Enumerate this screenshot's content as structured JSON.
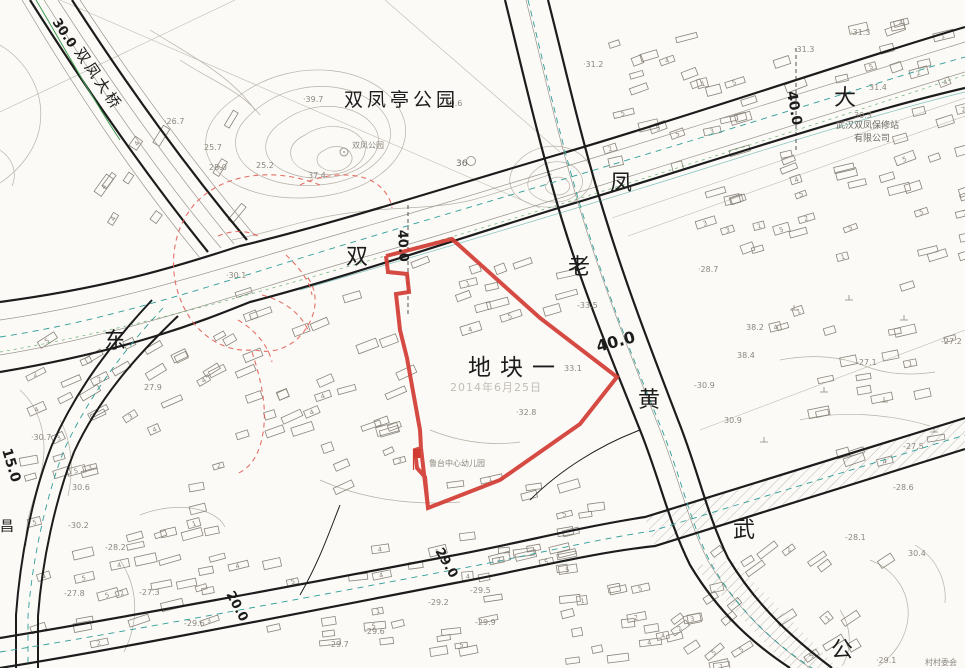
{
  "map": {
    "plot_label": "地块一",
    "date_watermark": "2014年6月25日",
    "labels": [
      {
        "name": "road-name-dong",
        "text": "东",
        "x": 104,
        "y": 348,
        "size": 22
      },
      {
        "name": "road-name-shuang",
        "text": "双",
        "x": 346,
        "y": 264,
        "size": 22
      },
      {
        "name": "road-name-feng",
        "text": "凤",
        "x": 610,
        "y": 190,
        "size": 22
      },
      {
        "name": "road-name-da",
        "text": "大",
        "x": 834,
        "y": 105,
        "size": 22
      },
      {
        "name": "road-name-lao",
        "text": "老",
        "x": 568,
        "y": 274,
        "size": 22
      },
      {
        "name": "road-name-huang",
        "text": "黄",
        "x": 638,
        "y": 407,
        "size": 22
      },
      {
        "name": "road-name-wu",
        "text": "武",
        "x": 733,
        "y": 537,
        "size": 22
      },
      {
        "name": "road-name-gong",
        "text": "公",
        "x": 831,
        "y": 657,
        "size": 22
      },
      {
        "name": "road-name-chang",
        "text": "昌",
        "x": 0,
        "y": 531,
        "size": 14
      },
      {
        "name": "bridge-name",
        "text": "双凤大桥",
        "x": 74,
        "y": 52,
        "size": 15,
        "rot": 56,
        "ls": 3
      },
      {
        "name": "park-name",
        "text": "双凤亭公园",
        "x": 344,
        "y": 106,
        "size": 19,
        "ls": 4
      },
      {
        "name": "park-subname",
        "text": "双凤公园",
        "x": 352,
        "y": 148,
        "size": 8,
        "color": "#8d887f"
      },
      {
        "name": "plot-name",
        "text": "地块一",
        "x": 468,
        "y": 375,
        "size": 23,
        "ls": 9
      },
      {
        "name": "date-watermark",
        "text": "2014年6月25日",
        "x": 450,
        "y": 391,
        "size": 11,
        "ls": 1,
        "color": "#c2beb6"
      },
      {
        "name": "road-width-30",
        "text": "30.0",
        "x": 52,
        "y": 22,
        "size": 13,
        "rot": 56,
        "bold": true
      },
      {
        "name": "road-width-40-a",
        "text": "40.0",
        "x": 398,
        "y": 230,
        "size": 13,
        "rot": 87,
        "bold": true
      },
      {
        "name": "road-width-40-b",
        "text": "40.0",
        "x": 787,
        "y": 92,
        "size": 14,
        "rot": 80,
        "bold": true
      },
      {
        "name": "road-width-40-c",
        "text": "40.0",
        "x": 598,
        "y": 352,
        "size": 16,
        "rot": -15,
        "bold": true
      },
      {
        "name": "road-width-15",
        "text": "15.0",
        "x": 2,
        "y": 450,
        "size": 14,
        "rot": 73,
        "bold": true
      },
      {
        "name": "road-width-20",
        "text": "20.0",
        "x": 226,
        "y": 594,
        "size": 13,
        "rot": 62,
        "bold": true
      },
      {
        "name": "road-width-29",
        "text": "29.0",
        "x": 435,
        "y": 551,
        "size": 13,
        "rot": 60,
        "bold": true
      },
      {
        "name": "kindergarten-label",
        "text": "鲁台中心幼儿园",
        "x": 429,
        "y": 466,
        "size": 8,
        "color": "#8d887f"
      },
      {
        "name": "company-label-line1",
        "text": "武汉双凤保修站",
        "x": 836,
        "y": 128,
        "size": 9,
        "color": "#6e6a63"
      },
      {
        "name": "company-label-line2",
        "text": "有限公司",
        "x": 854,
        "y": 141,
        "size": 9,
        "color": "#6e6a63"
      },
      {
        "name": "committee-label",
        "text": "村村委会",
        "x": 925,
        "y": 665,
        "size": 8,
        "color": "#8d887f"
      },
      {
        "name": "hill-36-label",
        "text": "36",
        "x": 456,
        "y": 166,
        "size": 9,
        "color": "#6e6a63"
      }
    ],
    "spot_elevations": [
      {
        "v": "·39.7",
        "x": 303,
        "y": 102
      },
      {
        "v": "·39.6",
        "x": 442,
        "y": 106
      },
      {
        "v": "37.4",
        "x": 308,
        "y": 178
      },
      {
        "v": "25.7",
        "x": 204,
        "y": 150
      },
      {
        "v": "28.0",
        "x": 209,
        "y": 170
      },
      {
        "v": "25.2",
        "x": 256,
        "y": 168
      },
      {
        "v": "·30.1",
        "x": 226,
        "y": 278
      },
      {
        "v": "·26.7",
        "x": 164,
        "y": 124
      },
      {
        "v": "·31.2",
        "x": 583,
        "y": 67
      },
      {
        "v": "·31.3",
        "x": 850,
        "y": 35
      },
      {
        "v": "·31.3",
        "x": 794,
        "y": 52
      },
      {
        "v": "31.4",
        "x": 869,
        "y": 90
      },
      {
        "v": "30.3",
        "x": 854,
        "y": 118
      },
      {
        "v": "·28.7",
        "x": 698,
        "y": 272
      },
      {
        "v": "-33.5",
        "x": 577,
        "y": 308
      },
      {
        "v": "33.1",
        "x": 564,
        "y": 371
      },
      {
        "v": "38.2",
        "x": 746,
        "y": 330
      },
      {
        "v": "38.4",
        "x": 737,
        "y": 358
      },
      {
        "v": "-30.9",
        "x": 694,
        "y": 388
      },
      {
        "v": "·32.8",
        "x": 516,
        "y": 415
      },
      {
        "v": "30.9",
        "x": 724,
        "y": 423
      },
      {
        "v": "-27.1",
        "x": 856,
        "y": 365
      },
      {
        "v": "-27.2",
        "x": 941,
        "y": 344
      },
      {
        "v": "-27.5",
        "x": 903,
        "y": 449
      },
      {
        "v": "-28.6",
        "x": 893,
        "y": 490
      },
      {
        "v": "-28.1",
        "x": 845,
        "y": 540
      },
      {
        "v": "30.4",
        "x": 908,
        "y": 556
      },
      {
        "v": "·30.7",
        "x": 31,
        "y": 440
      },
      {
        "v": "27.9",
        "x": 144,
        "y": 390
      },
      {
        "v": "30.6",
        "x": 72,
        "y": 490
      },
      {
        "v": "-30.2",
        "x": 68,
        "y": 528
      },
      {
        "v": "-28.2",
        "x": 105,
        "y": 550
      },
      {
        "v": "-27.8",
        "x": 64,
        "y": 596
      },
      {
        "v": "-27.3",
        "x": 139,
        "y": 595
      },
      {
        "v": "-29.6",
        "x": 184,
        "y": 626
      },
      {
        "v": "-29.2",
        "x": 428,
        "y": 605
      },
      {
        "v": "-29.6",
        "x": 364,
        "y": 634
      },
      {
        "v": "-29.7",
        "x": 328,
        "y": 647
      },
      {
        "v": "-29.5",
        "x": 470,
        "y": 593
      },
      {
        "v": "-29.9",
        "x": 475,
        "y": 625
      },
      {
        "v": "·29.1",
        "x": 876,
        "y": 663
      }
    ],
    "storey_digits": [
      "1",
      "2",
      "3",
      "4",
      "5"
    ],
    "colors": {
      "parcel_red": "#d13b32",
      "revision_red": "#e2574d",
      "survey_teal": "#2f9d97",
      "vegetation_green": "#3f9d4f",
      "road_line": "#1c1c1c",
      "contour": "#b7b1a6",
      "building": "#8a857c",
      "elevation_text": "#8d887f",
      "watermark": "#c2beb6"
    }
  }
}
